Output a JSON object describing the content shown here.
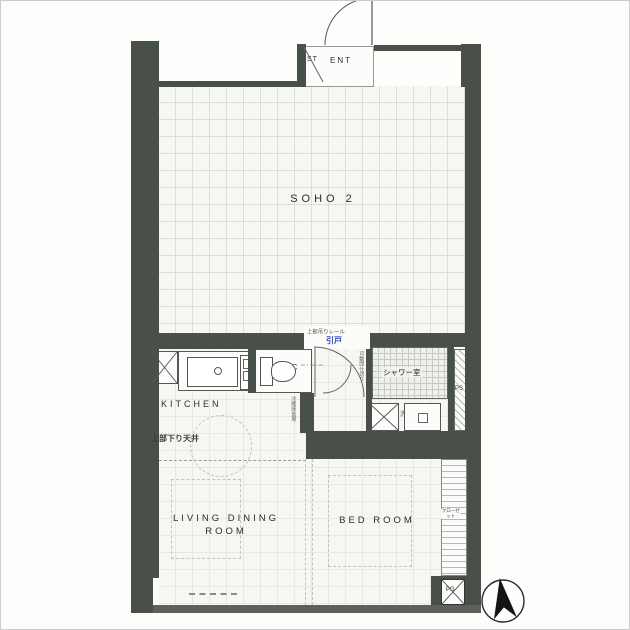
{
  "colors": {
    "bg": "#fdfdfc",
    "frame": "#cccccc",
    "wall": "#49504a",
    "wall-light": "#5c615a",
    "floor": "#f6f6f3",
    "grid": "#dcddd8",
    "grid-faint": "#e7e7e3",
    "tile": "#c7cac4",
    "hatch": "#b6b9b3",
    "dash": "#c3c3be",
    "label": "#2e2e2e",
    "accent-blue": "#3a46b4"
  },
  "plan": {
    "rooms": {
      "soho": "SOHO 2",
      "st": "ST",
      "ent": "ENT",
      "kitchen": "KITCHEN",
      "wc": "WC",
      "shower": "シャワー室",
      "ps": "PS",
      "living_line1": "LIVING DINING",
      "living_line2": "ROOM",
      "bedroom": "BED ROOM",
      "closet": "クローゼット",
      "pg": "PG",
      "laundry": "洗"
    },
    "notes": {
      "dropped_ceiling": "上部下り天井",
      "partition_gray": "上部吊りレール",
      "partition_blue": "引戸",
      "left_vertical": "冷蔵庫置場",
      "right_vertical": "可動間仕切り"
    }
  }
}
